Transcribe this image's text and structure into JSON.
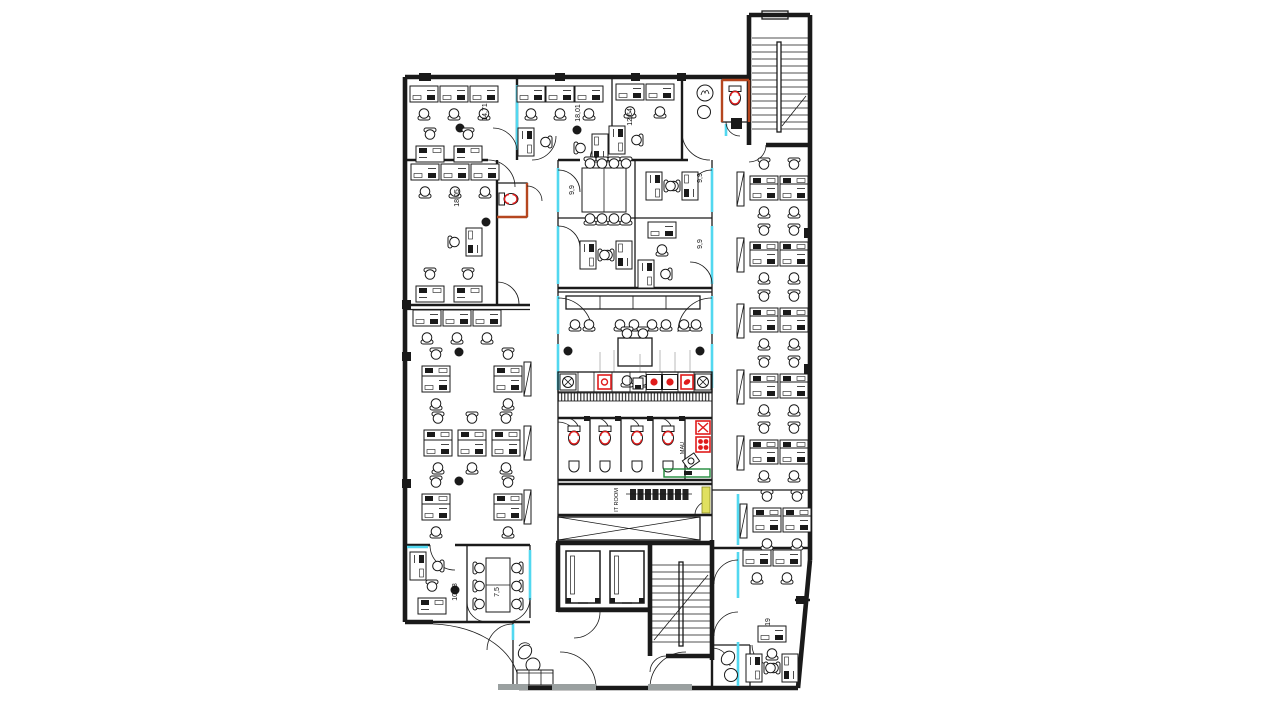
{
  "drawing": {
    "type": "architectural-floor-plan",
    "description": "Office floor plan with open-plan workstations, cellular offices, core with stairs, elevators, WCs, kitchen and IT room",
    "rooms": [
      {
        "id": "office-top-left",
        "label": "14,71"
      },
      {
        "id": "office-top-mid",
        "label": "18,01"
      },
      {
        "id": "office-top-right",
        "label": "12,64"
      },
      {
        "id": "office-left",
        "label": "18,05"
      },
      {
        "id": "meeting-room-center",
        "label": "9,9"
      },
      {
        "id": "office-center-right",
        "label": "9,9"
      },
      {
        "id": "office-center-lower-right",
        "label": "9,9"
      },
      {
        "id": "office-bottom-left",
        "label": "10,08"
      },
      {
        "id": "meeting-room-bottom-left",
        "label": "7,5"
      },
      {
        "id": "office-bottom-right",
        "label": "19"
      }
    ],
    "service_labels": {
      "mau": "MAU",
      "it_room": "IT ROOM"
    },
    "colors": {
      "wall": "#1a1a1a",
      "glazing": "#52d8f0",
      "fixture": "#e01b1b",
      "accent_orange": "#b5461f",
      "counter_green": "#1f8a3a",
      "tag_yellow": "#e0e060",
      "door_gray": "#9aa0a0",
      "background": "#ffffff"
    }
  }
}
